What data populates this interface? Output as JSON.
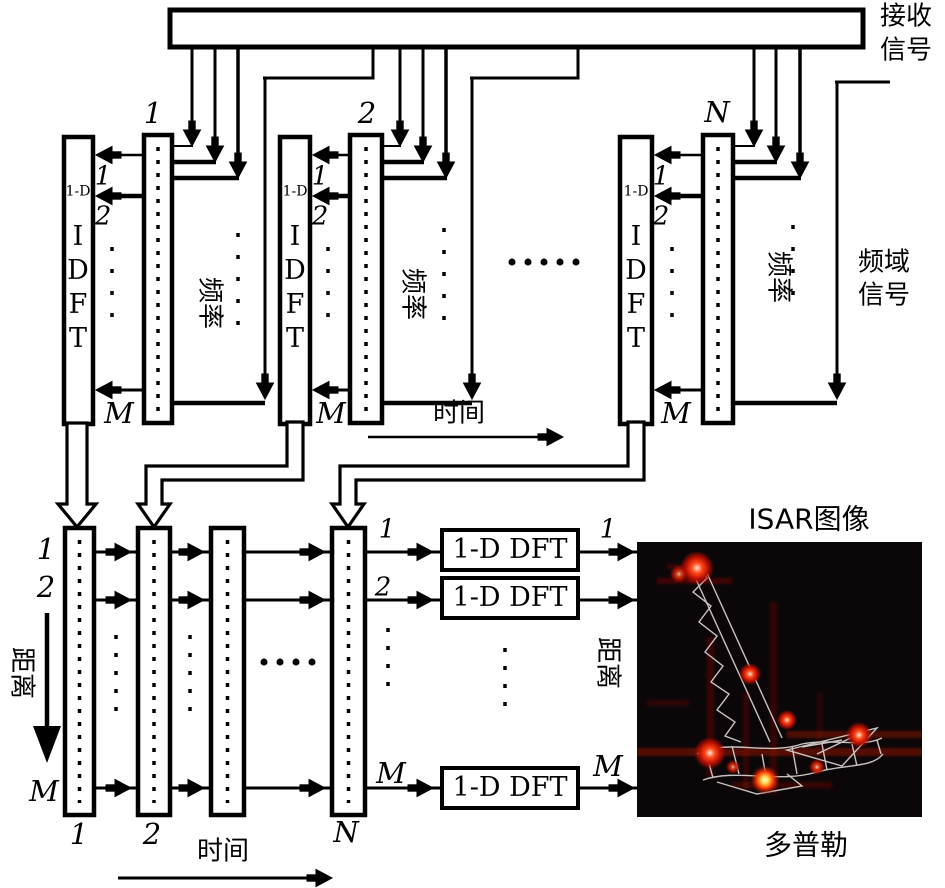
{
  "bus": {
    "label_l1": "接收",
    "label_l2": "信号"
  },
  "top_groups": [
    {
      "num": "1",
      "idft_prefix": "1-D",
      "idft_vertical": "I\nD\nF\nT",
      "r1": "1",
      "r2": "2",
      "rm": "M",
      "freq": "频率"
    },
    {
      "num": "2",
      "idft_prefix": "1-D",
      "idft_vertical": "I\nD\nF\nT",
      "r1": "1",
      "r2": "2",
      "rm": "M",
      "freq": "频率"
    },
    {
      "num": "N",
      "idft_prefix": "1-D",
      "idft_vertical": "I\nD\nF\nT",
      "r1": "1",
      "r2": "2",
      "rm": "M",
      "freq": "频率"
    }
  ],
  "top": {
    "time": "时间",
    "freq_domain_l1": "频域",
    "freq_domain_l2": "信号"
  },
  "bottom": {
    "rows": {
      "r1": "1",
      "r2": "2",
      "rm": "M"
    },
    "range_left": "距离",
    "cols": {
      "c1": "1",
      "c2": "2",
      "cn": "N"
    },
    "time": "时间",
    "coln_out": {
      "r1": "1",
      "r2": "2",
      "rm": "M"
    },
    "dft_label": "1-D DFT",
    "dft_out": {
      "r1": "1",
      "rm": "M"
    },
    "range_right": "距离"
  },
  "isar": {
    "title": "ISAR图像",
    "doppler": "多普勒"
  },
  "colors": {
    "line": "#000000",
    "background": "#ffffff",
    "image_bg": "#0b0708",
    "hotspot": "#ff2a00",
    "wireframe": "#c9c4c2"
  }
}
